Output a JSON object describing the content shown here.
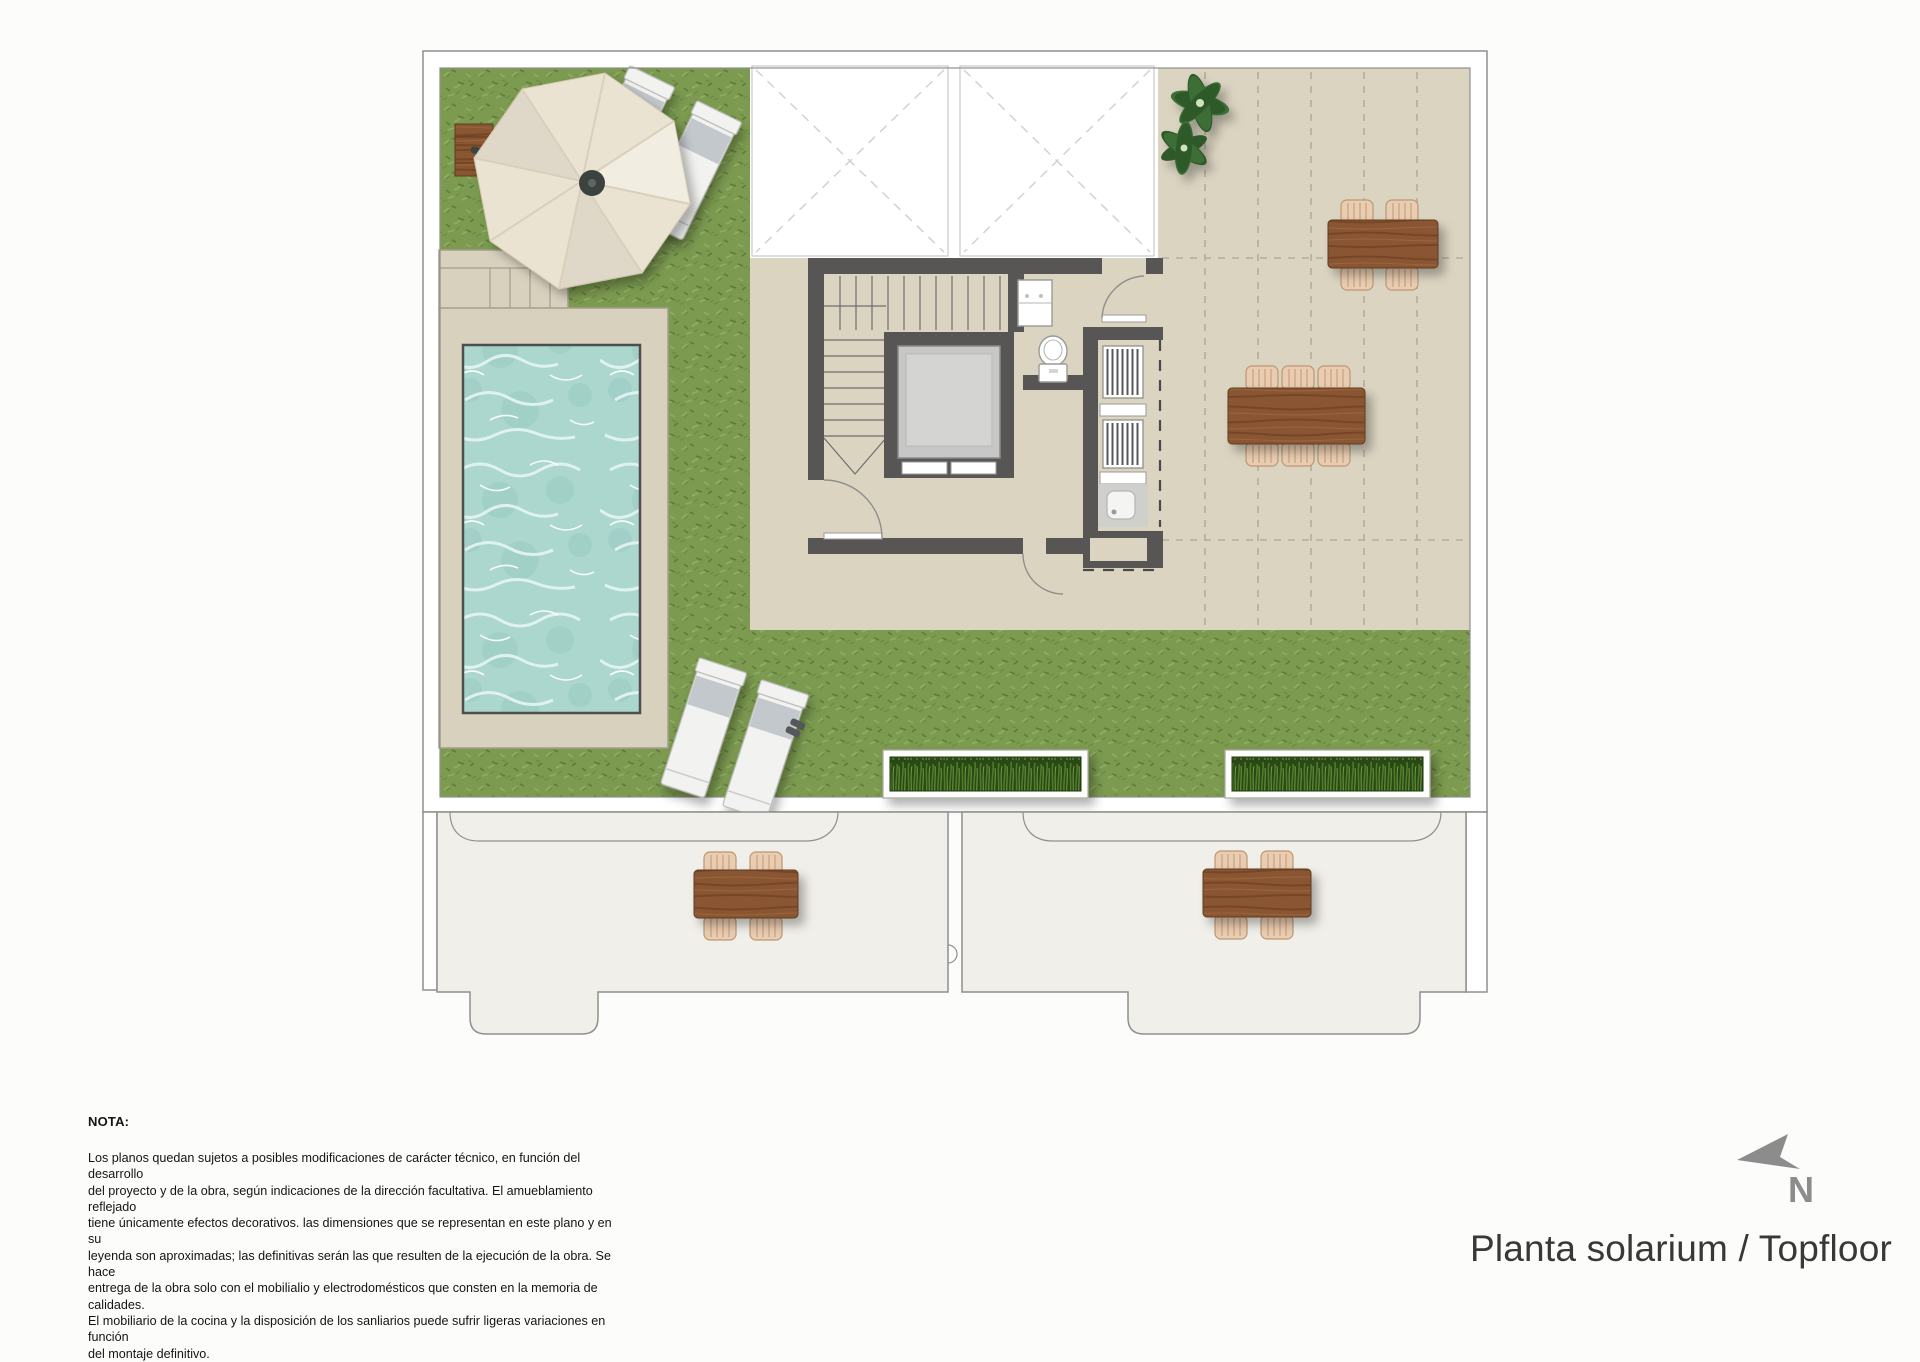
{
  "plan": {
    "title": "Planta solarium / Topfloor",
    "north_label": "N"
  },
  "note": {
    "heading": "NOTA:",
    "lines": [
      "Los planos quedan sujetos a posibles modificaciones de carácter técnico, en función del desarrollo",
      "del proyecto y de la obra, según indicaciones de la dirección facultativa. El amueblamiento reflejado",
      "tiene únicamente efectos decorativos. las dimensiones que se representan en este plano y en su",
      "leyenda son aproximadas; las definitivas serán las que resulten de la ejecución de la obra. Se hace",
      "entrega de la obra solo con el mobilialio y electrodomésticos que consten en la memoria de calidades.",
      "El mobiliario de la cocina y la disposición de los sanliarios puede sufrir ligeras variaciones en función",
      "del montaje definitivo."
    ]
  },
  "palette": {
    "page_bg": "#fcfcfb",
    "band": "#ffffff",
    "outline": "#8f8f8d",
    "grass_base": "#7c9a50",
    "terrace": "#dbd4c1",
    "tile_line": "#b5ad9b",
    "pool_deck": "#d8d1be",
    "water": "#abd7cf",
    "wall": "#575655",
    "elevator": "#c7c7c7",
    "wood": "#8a5531",
    "chair": "#e9cdb2",
    "planter_green": "#2a4618",
    "lounger": "#f2f2f0",
    "lounger_band": "#c3c8cd",
    "umbrella": "#ebe3d2",
    "umbrella_seam": "#d9cfba",
    "pole": "#3c4442",
    "lower_terrace": "#f0efe9",
    "arrow_gray": "#8c8c8c",
    "text_dark": "#141414",
    "title_color": "#383838"
  }
}
